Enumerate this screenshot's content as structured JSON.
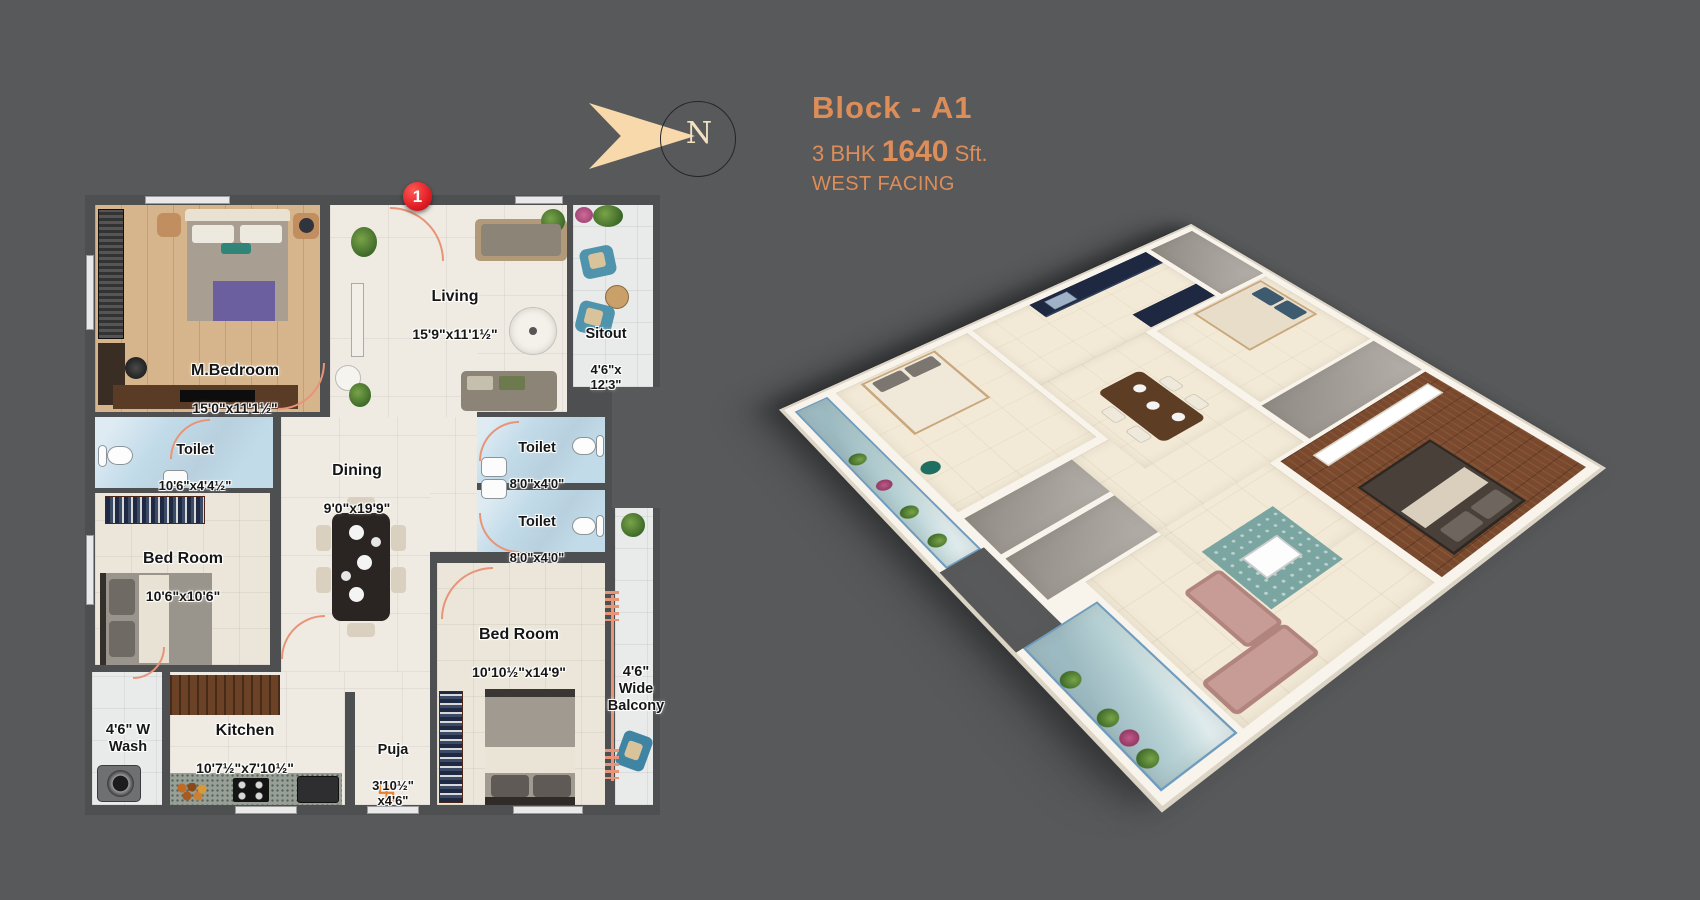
{
  "header": {
    "block": "Block - A1",
    "spec_prefix": "3 BHK",
    "spec_area": "1640",
    "spec_suffix": "Sft.",
    "facing": "WEST FACING"
  },
  "compass": {
    "letter": "N"
  },
  "entrance": {
    "badge": "1"
  },
  "plan": {
    "rooms": {
      "master_bedroom": {
        "name": "M.Bedroom",
        "dims": "15'0\"x11'1½\""
      },
      "living": {
        "name": "Living",
        "dims": "15'9\"x11'1½\""
      },
      "sitout": {
        "name": "Sitout",
        "dims": "4'6\"x\n12'3\""
      },
      "toilet_master": {
        "name": "Toilet",
        "dims": "10'6\"x4'4½\""
      },
      "dining": {
        "name": "Dining",
        "dims": "9'0\"x19'9\""
      },
      "toilet_1": {
        "name": "Toilet",
        "dims": "8'0\"x4'0\""
      },
      "toilet_2": {
        "name": "Toilet",
        "dims": "8'0\"x4'0\""
      },
      "bedroom_1": {
        "name": "Bed Room",
        "dims": "10'6\"x10'6\""
      },
      "wash": {
        "name": "4'6\" W\nWash"
      },
      "kitchen": {
        "name": "Kitchen",
        "dims": "10'7½\"x7'10½\""
      },
      "puja": {
        "name": "Puja",
        "dims": "3'10½\"\nx4'6\""
      },
      "bedroom_2": {
        "name": "Bed Room",
        "dims": "10'10½\"x14'9\""
      },
      "balcony": {
        "name": "4'6\"\nWide\nBalcony"
      }
    },
    "puja_symbol": "卐"
  },
  "colors": {
    "bg": "#58595b",
    "wall": "#4e4f51",
    "accent": "#dd8d58",
    "door": "#e89478",
    "badge": "#e01e25",
    "marble": "#efebe2",
    "wood": "#d6b58c",
    "toilet": "#c2dbe9",
    "tile": "#e9eaea",
    "bedroom": "#ebe6d9"
  }
}
